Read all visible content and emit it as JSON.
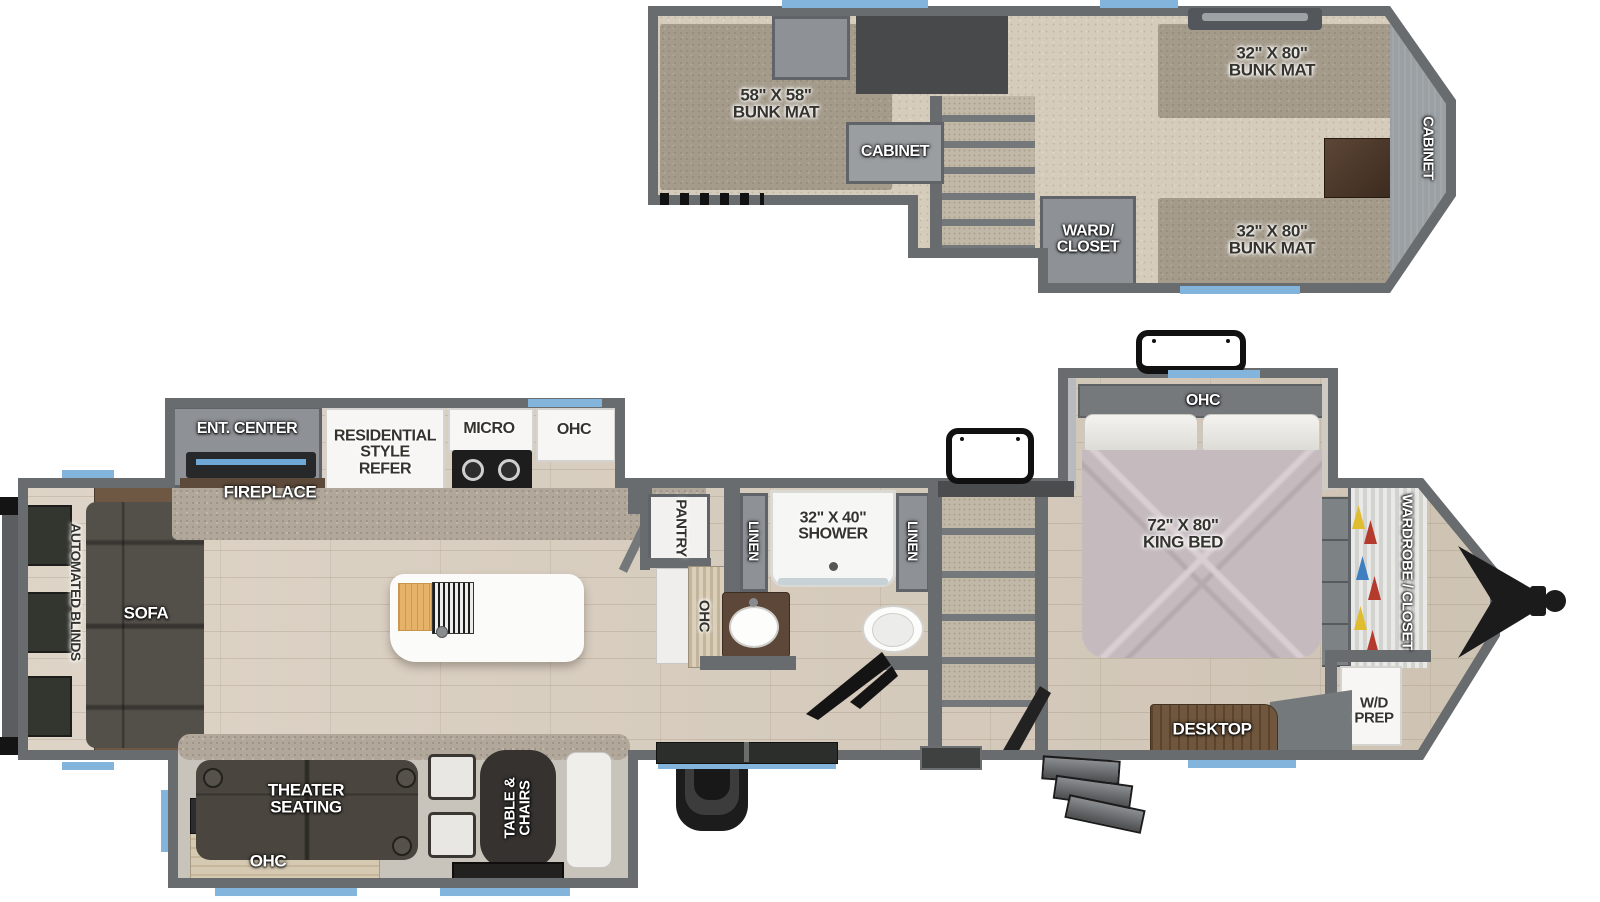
{
  "title": "Fifth wheel RV two-level floor plan",
  "palette": {
    "wall": "#686c6f",
    "accent_blue": "#82b4dc",
    "carpet": "#d6ccbc",
    "bunk_mat": "#a49b8b",
    "wood_floor": "#d8cec1",
    "counter_speckle": "#b1a79a",
    "cabinet_gray": "#8e9296",
    "sofa_dark": "#514d47",
    "bed_comforter": "#c5bbbf",
    "desk_wood": "#6f563d",
    "cutting_board": "#e6b168",
    "white_fixture": "#f7f6f4"
  },
  "upper_level": {
    "bunk_left_label": "58\" X 58\"\nBUNK MAT",
    "cabinet_label": "CABINET",
    "ward_closet_label": "WARD/\nCLOSET",
    "bunk_top_label": "32\" X 80\"\nBUNK MAT",
    "bunk_bottom_label": "32\" X 80\"\nBUNK MAT",
    "front_cabinet_label": "CABINET"
  },
  "main_level": {
    "ent_center_label": "ENT. CENTER",
    "fireplace_label": "FIREPLACE",
    "refer_label": "RESIDENTIAL\nSTYLE\nREFER",
    "micro_label": "MICRO",
    "kitchen_ohc_label": "OHC",
    "automated_blinds_label": "AUTOMATED BLINDS",
    "sofa_label": "SOFA",
    "pantry_label": "PANTRY",
    "pantry_ohc_label": "OHC",
    "linen_left_label": "LINEN",
    "linen_right_label": "LINEN",
    "shower_label": "32\" X 40\"\nSHOWER",
    "king_bed_label": "72\" X 80\"\nKING BED",
    "bed_ohc_label": "OHC",
    "wardrobe_label": "WARDROBE / CLOSET",
    "wd_prep_label": "W/D\nPREP",
    "desktop_label": "DESKTOP",
    "theater_label": "THEATER\nSEATING",
    "theater_ohc_label": "OHC",
    "table_chairs_label": "TABLE &\nCHAIRS"
  }
}
